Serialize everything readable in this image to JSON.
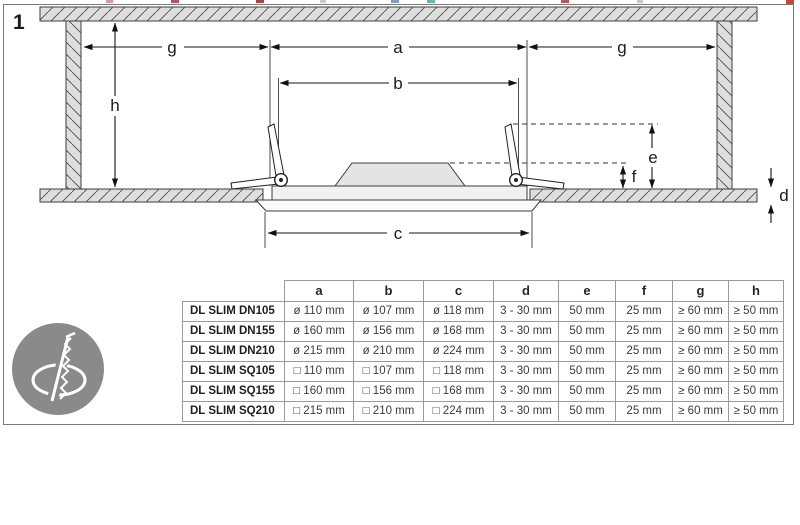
{
  "figure": {
    "number": "1"
  },
  "diagram": {
    "labels": {
      "g_left": "g",
      "a": "a",
      "g_right": "g",
      "h": "h",
      "b": "b",
      "e": "e",
      "f": "f",
      "c": "c",
      "d": "d"
    }
  },
  "icon": {
    "semantic": "hole-saw-cutout-icon",
    "color": "#8a8a8a"
  },
  "colors": {
    "hatch_fill": "#dedede",
    "outline": "#3c3c3c",
    "table_border": "#9a9a9a"
  },
  "table": {
    "headers": [
      "",
      "a",
      "b",
      "c",
      "d",
      "e",
      "f",
      "g",
      "h"
    ],
    "rows": [
      {
        "model": "DL SLIM DN105",
        "values": [
          "ø 110 mm",
          "ø 107 mm",
          "ø 118 mm",
          "3 - 30 mm",
          "50 mm",
          "25 mm",
          "≥ 60 mm",
          "≥ 50 mm"
        ]
      },
      {
        "model": "DL SLIM DN155",
        "values": [
          "ø 160 mm",
          "ø 156 mm",
          "ø 168 mm",
          "3 - 30 mm",
          "50 mm",
          "25 mm",
          "≥ 60 mm",
          "≥ 50 mm"
        ]
      },
      {
        "model": "DL SLIM DN210",
        "values": [
          "ø 215 mm",
          "ø 210 mm",
          "ø 224 mm",
          "3 - 30 mm",
          "50 mm",
          "25 mm",
          "≥ 60 mm",
          "≥ 50 mm"
        ]
      },
      {
        "model": "DL SLIM SQ105",
        "values": [
          "□ 110 mm",
          "□ 107 mm",
          "□ 118 mm",
          "3 - 30 mm",
          "50 mm",
          "25 mm",
          "≥ 60 mm",
          "≥ 50 mm"
        ]
      },
      {
        "model": "DL SLIM SQ155",
        "values": [
          "□ 160 mm",
          "□ 156 mm",
          "□ 168 mm",
          "3 - 30 mm",
          "50 mm",
          "25 mm",
          "≥ 60 mm",
          "≥ 50 mm"
        ]
      },
      {
        "model": "DL SLIM SQ210",
        "values": [
          "□ 215 mm",
          "□ 210 mm",
          "□ 224 mm",
          "3 - 30 mm",
          "50 mm",
          "25 mm",
          "≥ 60 mm",
          "≥ 50 mm"
        ]
      }
    ]
  }
}
